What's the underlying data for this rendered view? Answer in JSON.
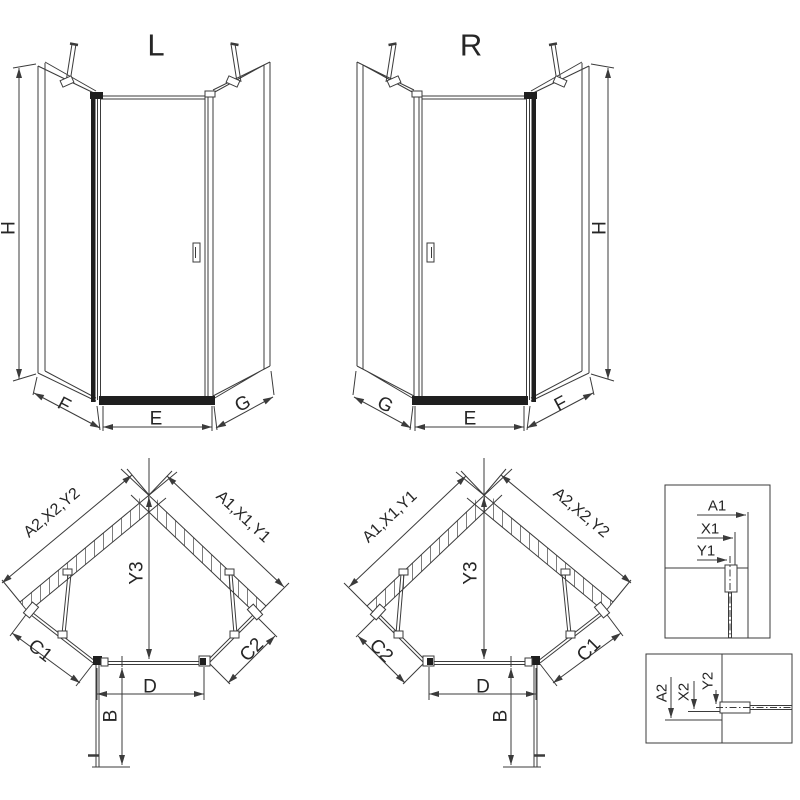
{
  "colors": {
    "line": "#3b3b3b",
    "dark": "#1f1f1f",
    "hatch": "#6f6f6f",
    "background": "#ffffff",
    "text": "#262626"
  },
  "elevation_left": {
    "title": "L",
    "height": "H",
    "left_panel": "F",
    "door_front": "E",
    "right_panel": "G"
  },
  "elevation_right": {
    "title": "R",
    "left_panel": "G",
    "door_front": "E",
    "right_panel": "F",
    "height": "H"
  },
  "plan_left": {
    "wall_left": "A2,X2,Y2",
    "wall_right": "A1,X1,Y1",
    "depth": "Y3",
    "fixed_left": "C1",
    "fixed_right": "C2",
    "door_width": "D",
    "door_swing": "B"
  },
  "plan_right": {
    "wall_left": "A1,X1,Y1",
    "wall_right": "A2,X2,Y2",
    "depth": "Y3",
    "fixed_left": "C2",
    "fixed_right": "C1",
    "door_width": "D",
    "door_swing": "B"
  },
  "detail_right_wall": {
    "wall": "A1",
    "profile": "X1",
    "glass_axis": "Y1"
  },
  "detail_left_wall": {
    "wall": "A2",
    "profile": "X2",
    "glass_axis": "Y2"
  }
}
